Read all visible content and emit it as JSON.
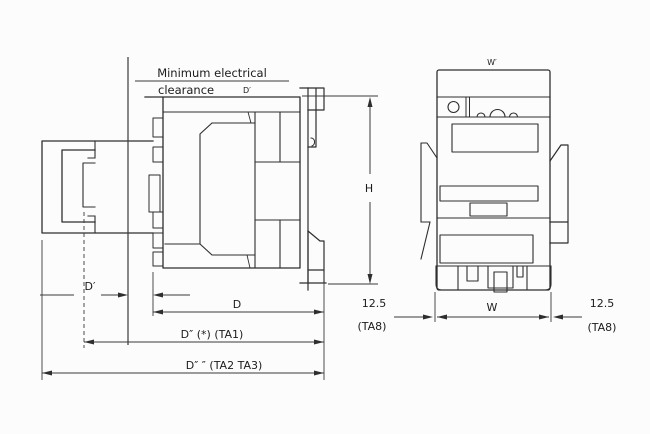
{
  "drawing": {
    "kind": "contactor dimensional drawing (side view and front view)",
    "note": {
      "line1": "Minimum electrical",
      "line2": "clearance",
      "suffix": "D′"
    },
    "dimensions": {
      "d_prime": "D′",
      "d": "D",
      "d_ta1": "D″ (*) (TA1)",
      "d_ta2_ta3": "D″ ″ (TA2 TA3)",
      "h": "H",
      "w_top": "W′",
      "w": "W",
      "side_left": {
        "value": "12.5",
        "ref": "(TA8)"
      },
      "side_right": {
        "value": "12.5",
        "ref": "(TA8)"
      }
    },
    "colors": {
      "line": "#2e2e2e",
      "dimension_line": "#3a3a3a",
      "background": "#fcfcfc",
      "text": "#1c1c1c"
    }
  }
}
